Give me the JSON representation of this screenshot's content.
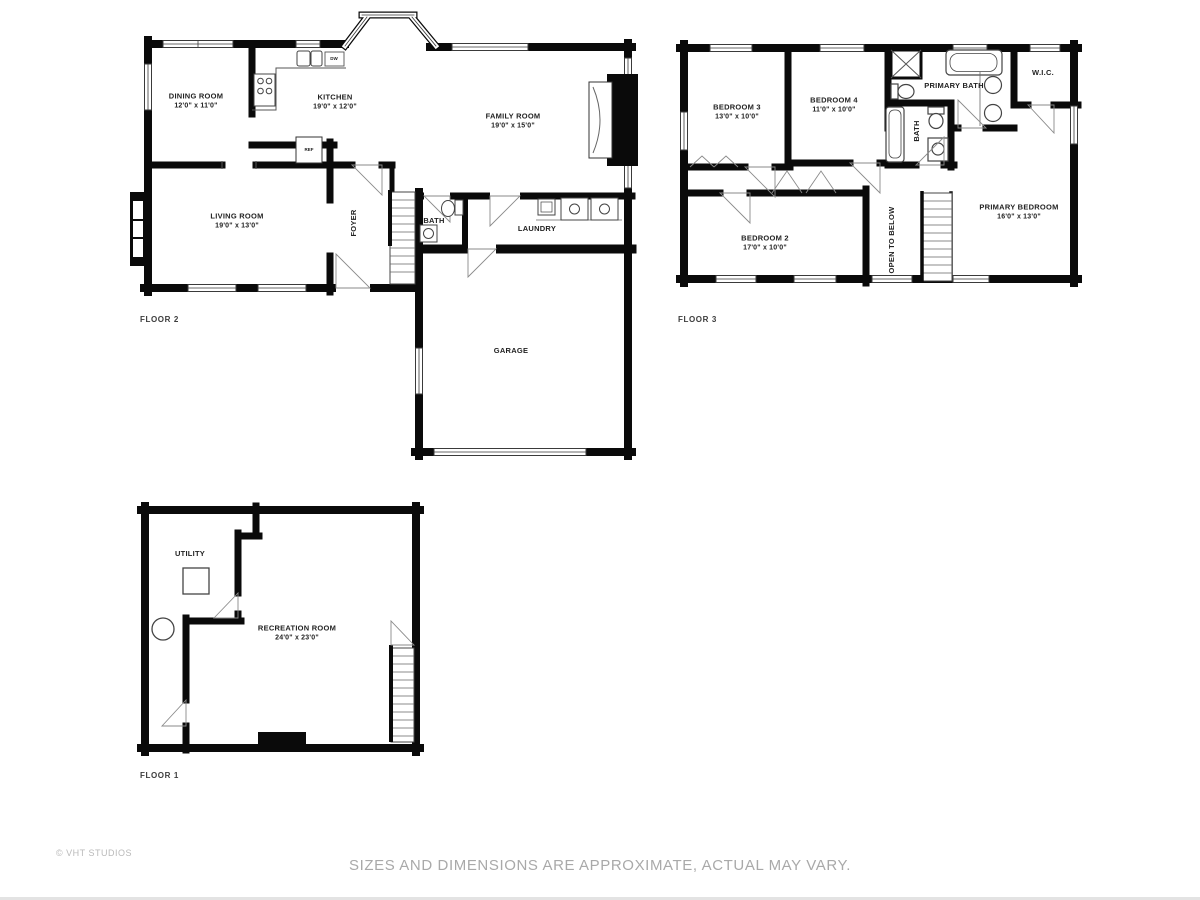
{
  "page": {
    "credit": "© VHT STUDIOS",
    "disclaimer": "SIZES AND DIMENSIONS ARE APPROXIMATE, ACTUAL MAY VARY."
  },
  "style": {
    "wall_color": "#0a0a0a",
    "label_color": "#222222",
    "footer_color": "#a9a9a9"
  },
  "floor2": {
    "caption": "FLOOR 2",
    "dining": {
      "name": "DINING ROOM",
      "dims": "12'0\" x 11'0\""
    },
    "kitchen": {
      "name": "KITCHEN",
      "dims": "19'0\" x 12'0\""
    },
    "family": {
      "name": "FAMILY ROOM",
      "dims": "19'0\" x 15'0\""
    },
    "living": {
      "name": "LIVING ROOM",
      "dims": "19'0\" x 13'0\""
    },
    "foyer": {
      "name": "FOYER"
    },
    "bath": {
      "name": "BATH"
    },
    "laundry": {
      "name": "LAUNDRY"
    },
    "garage": {
      "name": "GARAGE"
    },
    "fridge": {
      "name": "REF"
    },
    "dishwasher": {
      "name": "DW"
    }
  },
  "floor3": {
    "caption": "FLOOR 3",
    "bedroom3": {
      "name": "BEDROOM 3",
      "dims": "13'0\" x 10'0\""
    },
    "bedroom4": {
      "name": "BEDROOM 4",
      "dims": "11'0\" x 10'0\""
    },
    "primary_bath": {
      "name": "PRIMARY BATH"
    },
    "wic": {
      "name": "W.I.C."
    },
    "bath": {
      "name": "BATH"
    },
    "bedroom2": {
      "name": "BEDROOM 2",
      "dims": "17'0\" x 10'0\""
    },
    "open_to_below": {
      "name": "OPEN TO BELOW"
    },
    "primary_bedroom": {
      "name": "PRIMARY BEDROOM",
      "dims": "16'0\" x 13'0\""
    }
  },
  "floor1": {
    "caption": "FLOOR 1",
    "utility": {
      "name": "UTILITY"
    },
    "recreation": {
      "name": "RECREATION ROOM",
      "dims": "24'0\" x 23'0\""
    }
  }
}
